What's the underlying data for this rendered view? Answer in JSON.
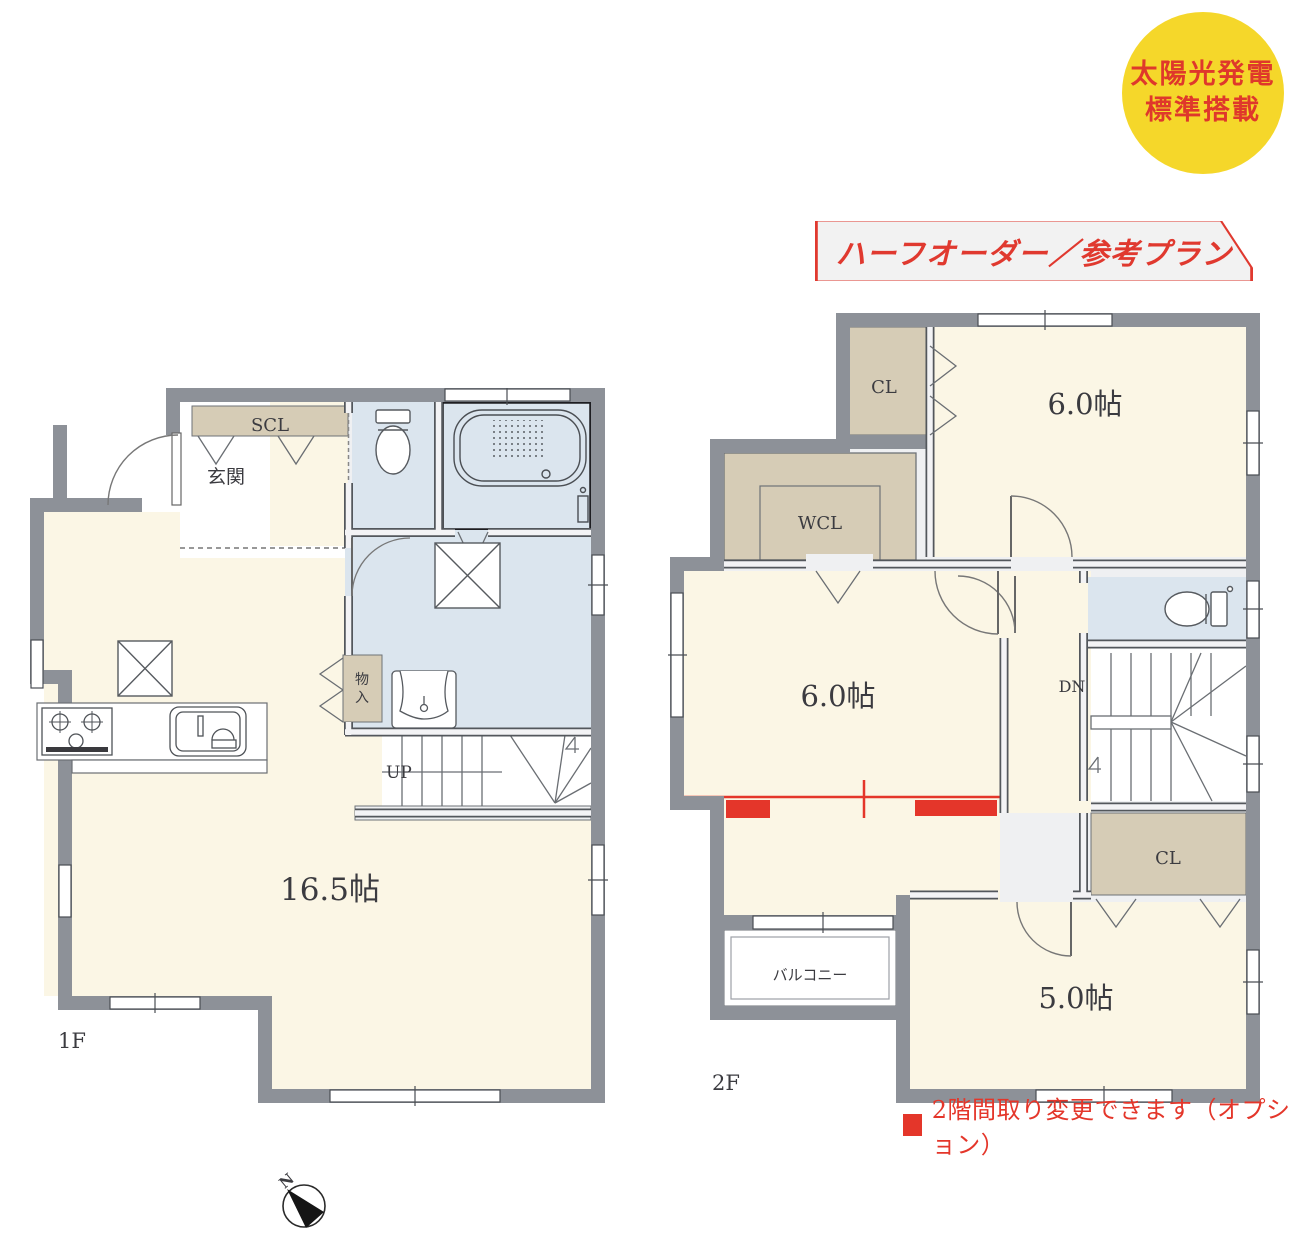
{
  "badge": {
    "line1": "太陽光発電",
    "line2": "標準搭載",
    "bg": "#F5D72A",
    "fg": "#DF382B"
  },
  "banner": {
    "text": "ハーフオーダー／参考プラン",
    "fg": "#E0392F",
    "bg": "#F2F2F2"
  },
  "floor1": {
    "label": "1F",
    "genkan": "玄関",
    "scl": "SCL",
    "monoire": [
      "物",
      "入"
    ],
    "up": "UP",
    "ldk": "16.5帖"
  },
  "floor2": {
    "label": "2F",
    "cl_north": "CL",
    "wcl": "WCL",
    "cl_south": "CL",
    "dn": "DN",
    "room_northeast": "6.0帖",
    "room_west": "6.0帖",
    "room_south": "5.0帖",
    "balcony": "バルコニー"
  },
  "note": {
    "text": "2階間取り変更できます（オプション）",
    "fg": "#E4362A"
  },
  "compass": {
    "north": "N"
  },
  "colors": {
    "wall": "#8D9198",
    "room_cream": "#FBF6E5",
    "closet_tan": "#D6CCB6",
    "wet_blue": "#DBE5EE",
    "corridor": "#EFF0F2",
    "accent_red": "#E4362A",
    "badge_yellow": "#F5D72A"
  }
}
